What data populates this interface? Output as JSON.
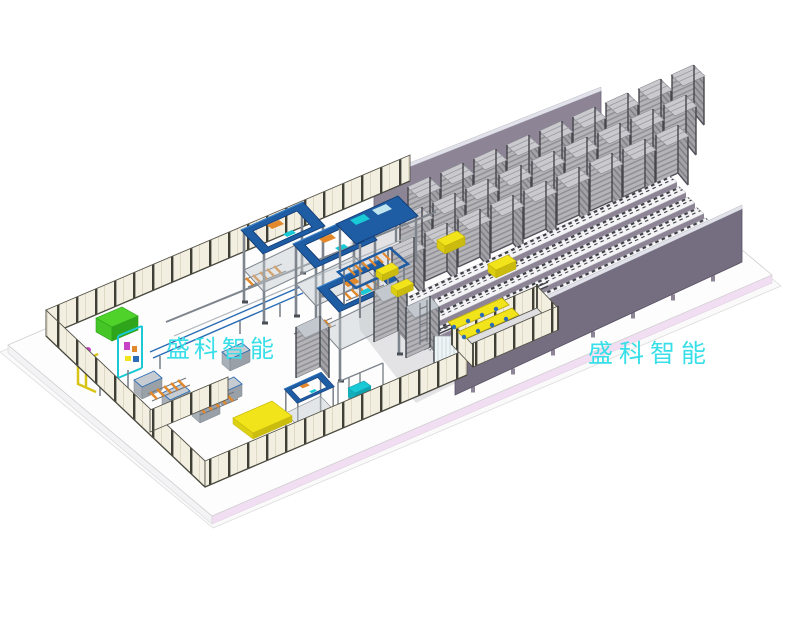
{
  "scene": {
    "watermarks": [
      {
        "text": "盛科智能",
        "position": "left-machine-area"
      },
      {
        "text": "盛科智能",
        "position": "right-floor"
      }
    ],
    "colors": {
      "watermark": "#38dfe8",
      "base_plate": "#fafafa",
      "floor_top": "#fdfdfd",
      "floor_side": "#f3f3f5",
      "floor_edge_pink": "#f2def2",
      "aisle": "#e3e3e6",
      "enclosure_floor": "#dfdfe2",
      "wall_back": "#8d8596",
      "wall_front": "#756d80",
      "wall_top_light": "#e2e2ea",
      "rack_body": "#b5b5b9",
      "rack_slat": "#8f8f94",
      "rack_body_dark": "#a2a2a7",
      "rack_slat_dark": "#7f7f85",
      "rack_post": "#46464d",
      "rack_lid": "#c9c9ce",
      "rail_top": "#f4f4f6",
      "rail_face": "#8d8596",
      "rail_teeth": "#3e3e45",
      "fence_panel": "#f2eee0",
      "fence_post": "#3f3f36",
      "machine_blue": "#1e5ca4",
      "machine_blue_dark": "#123c74",
      "steel": "#7e858d",
      "steel_light": "#aeb4ba",
      "accent_cyan": "#19c9d6",
      "accent_green": "#4fd32b",
      "accent_magenta": "#c643c6",
      "accent_orange": "#e2882a",
      "accent_yellow": "#f2e41a"
    }
  }
}
